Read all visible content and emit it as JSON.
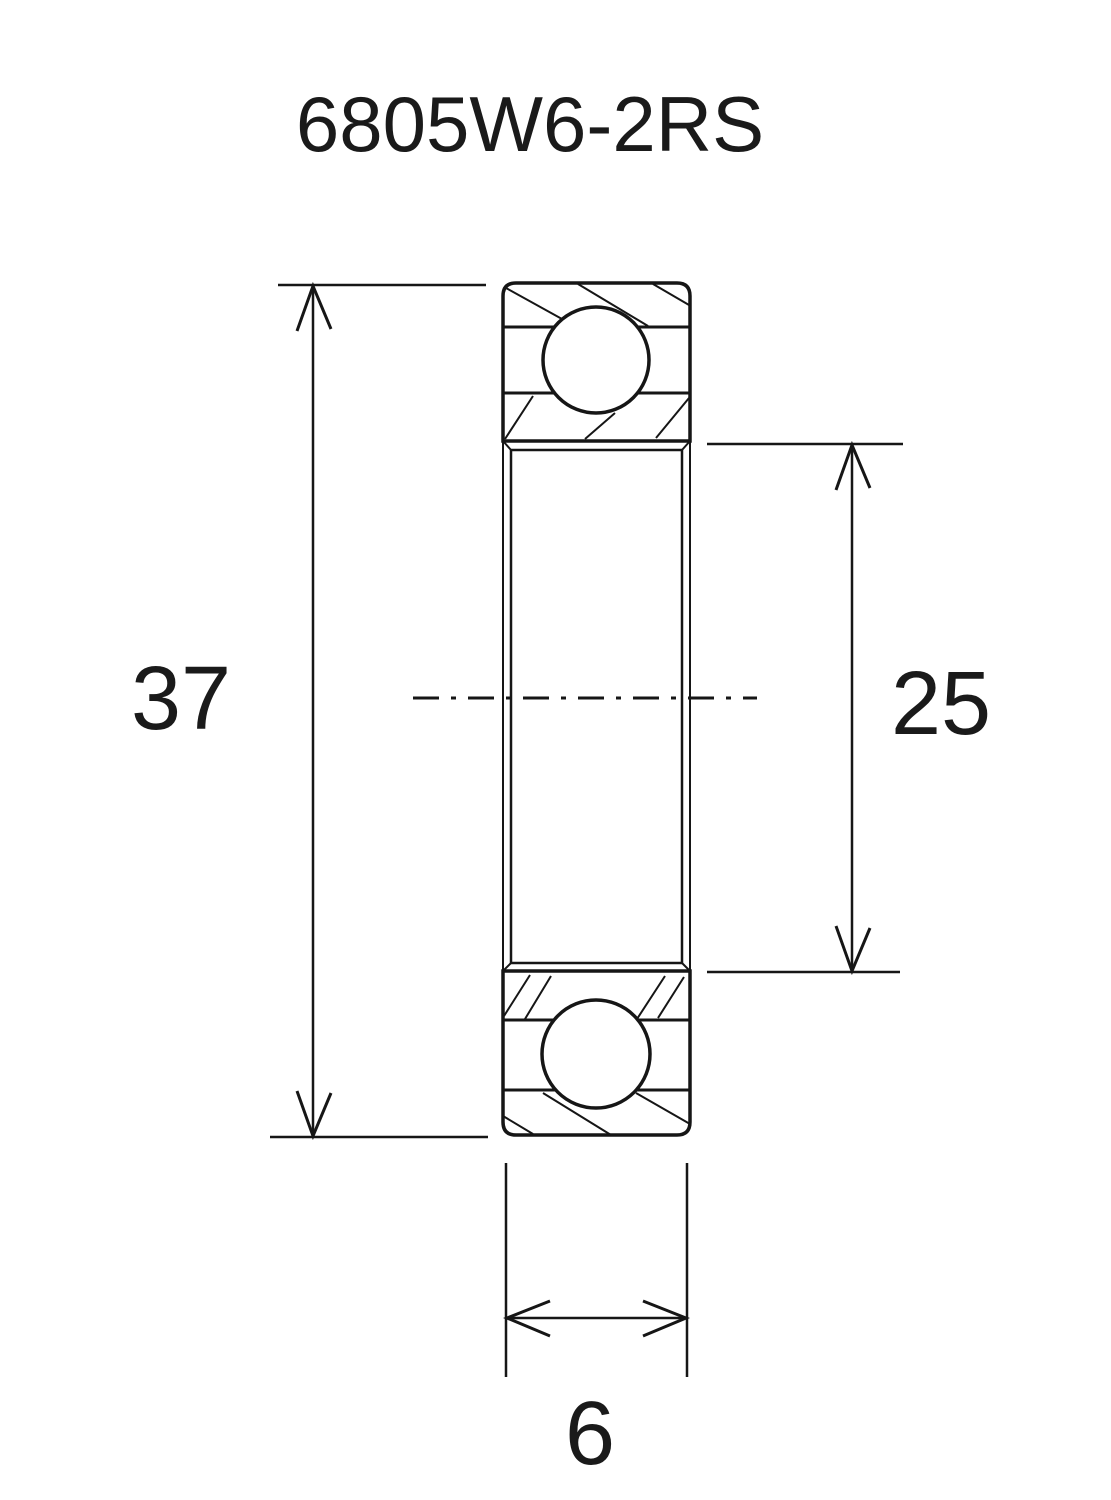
{
  "page": {
    "background": "#ffffff",
    "ink_color": "#161616"
  },
  "drawing": {
    "title": "6805W6-2RS",
    "kind": "ball-bearing-cross-section",
    "dimensions": {
      "outer_diameter": {
        "value": "37",
        "side": "left",
        "orientation": "vertical"
      },
      "bore_diameter": {
        "value": "25",
        "side": "right",
        "orientation": "vertical"
      },
      "width": {
        "value": "6",
        "side": "bottom",
        "orientation": "horizontal"
      }
    }
  }
}
